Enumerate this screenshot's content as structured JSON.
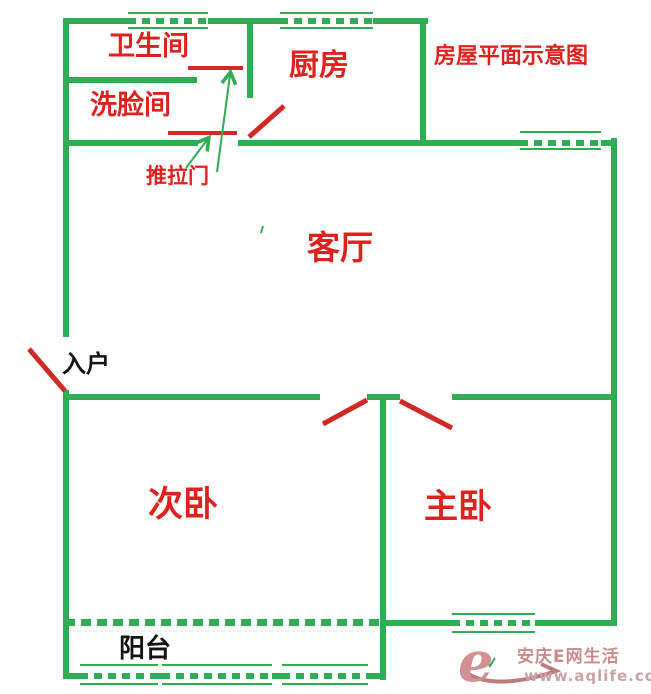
{
  "title": "房屋平面示意图",
  "labels": {
    "bathroom": "卫生间",
    "washroom": "洗脸间",
    "kitchen": "厨房",
    "living_room": "客厅",
    "second_bedroom": "次卧",
    "master_bedroom": "主卧",
    "balcony": "阳台",
    "sliding_door": "推拉门",
    "entrance": "入户"
  },
  "watermark": {
    "logo_letter": "e",
    "site_name": "安庆E网生活",
    "site_url": "www.aqlife.com"
  },
  "colors": {
    "wall_green": "#2fad55",
    "label_red": "#e0221e",
    "door_red": "#cf2b24",
    "text_black": "#141414",
    "watermark_pink": "#d39292"
  }
}
